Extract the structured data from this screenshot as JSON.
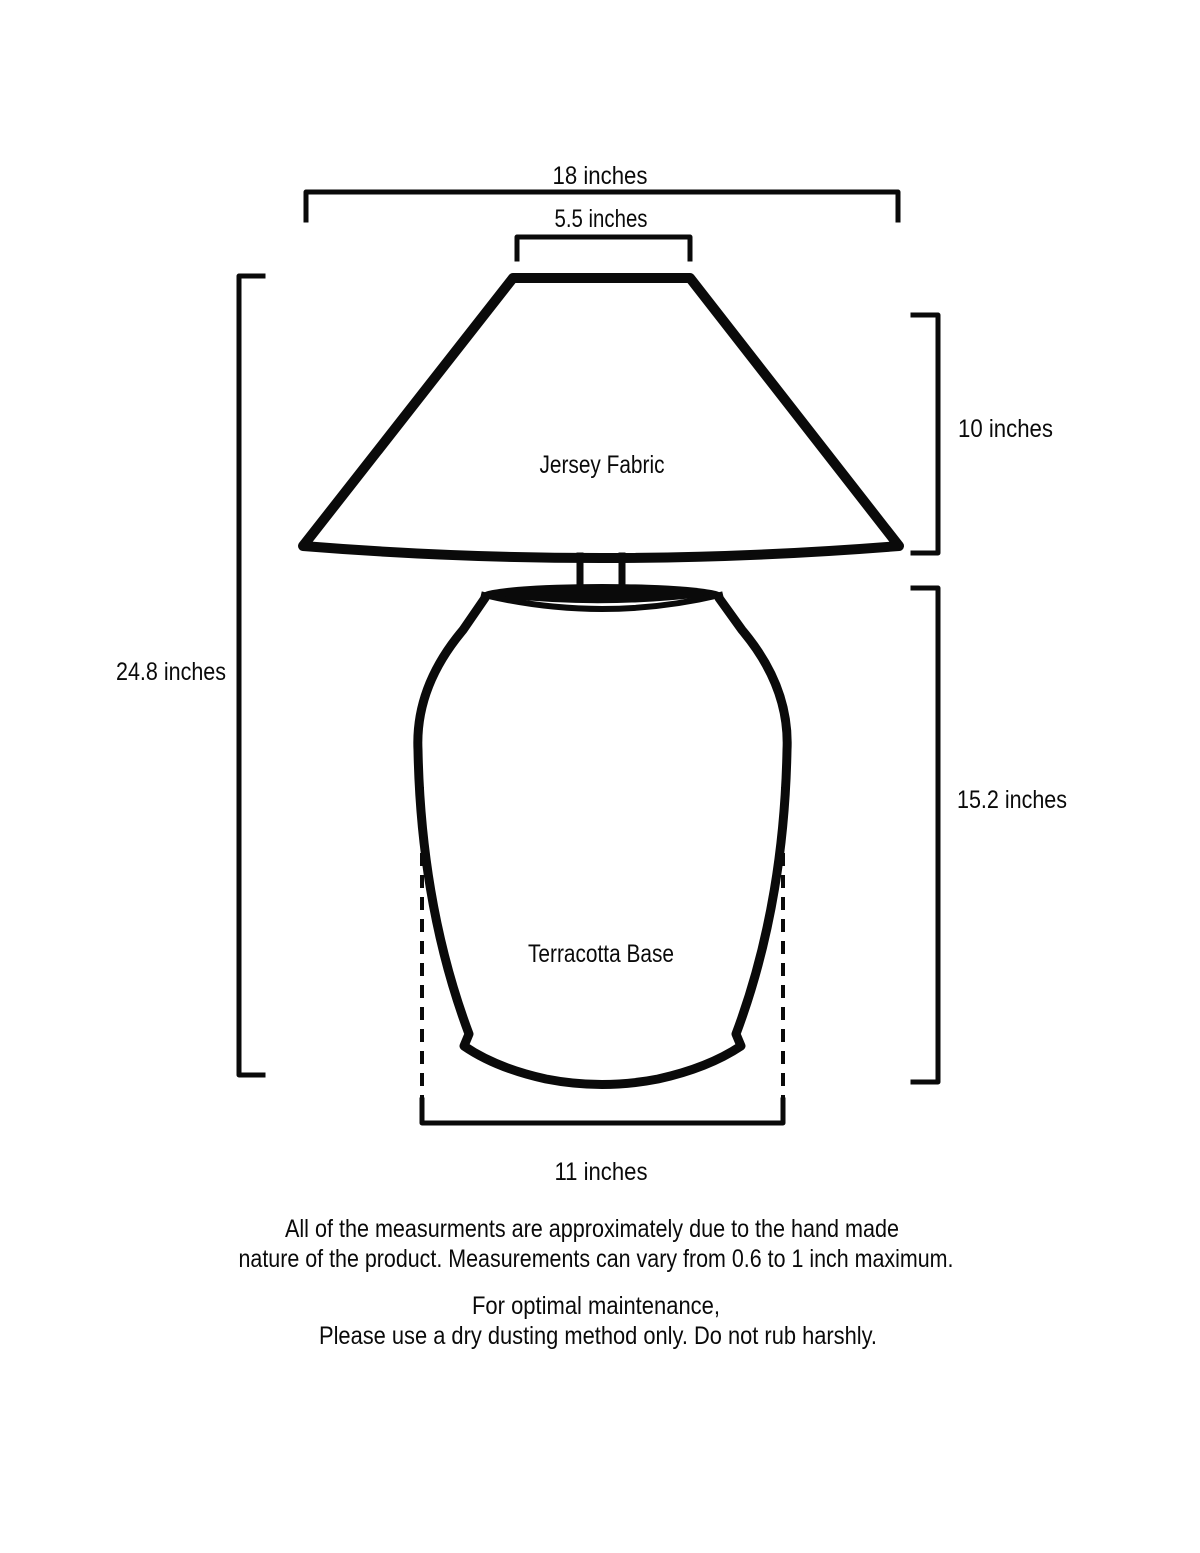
{
  "page": {
    "background_color": "#ffffff",
    "ink_color": "#0a0a0a"
  },
  "diagram": {
    "type": "product-dimension-diagram",
    "subject": "table lamp",
    "labels": {
      "shade_material": "Jersey Fabric",
      "base_material": "Terracotta Base"
    },
    "dimensions": {
      "shade_bottom_width": "18 inches",
      "shade_top_width": "5.5 inches",
      "shade_height": "10 inches",
      "total_height": "24.8 inches",
      "base_height": "15.2 inches",
      "base_width": "11 inches"
    }
  },
  "notes": {
    "tolerance_line1": "All of the measurments are approximately due to the hand made",
    "tolerance_line2": "nature of the product. Measurements can vary from 0.6 to 1 inch maximum.",
    "care_line1": "For optimal maintenance,",
    "care_line2": "Please use a dry dusting method only. Do not rub harshly."
  }
}
